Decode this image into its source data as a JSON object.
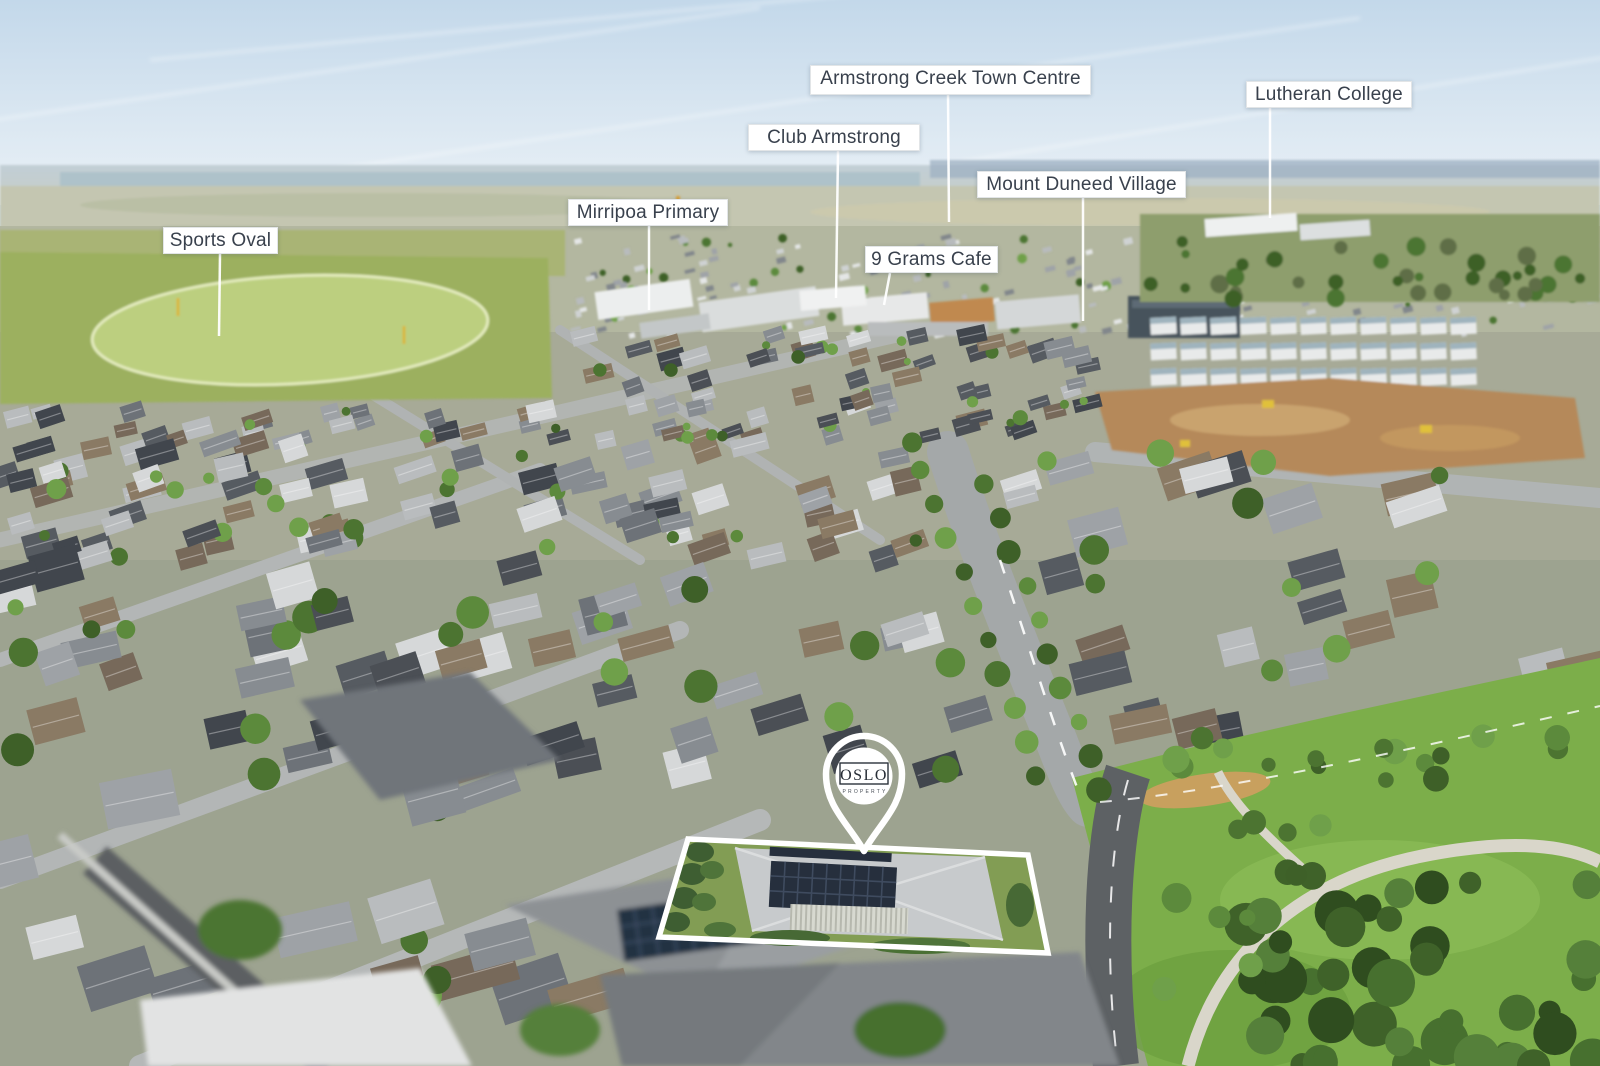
{
  "scene": {
    "type": "aerial drone photograph",
    "description": "Aerial view over a new housing estate with location callouts and a highlighted property"
  },
  "labels": [
    {
      "id": "sports-oval",
      "text": "Sports Oval",
      "box": {
        "x": 163,
        "y": 227,
        "w": 115,
        "h": 27
      },
      "line": {
        "x1": 220,
        "y1": 254,
        "x2": 219,
        "y2": 336
      }
    },
    {
      "id": "mirripoa-primary",
      "text": "Mirripoa Primary",
      "box": {
        "x": 568,
        "y": 199,
        "w": 160,
        "h": 27
      },
      "line": {
        "x1": 649,
        "y1": 226,
        "x2": 649,
        "y2": 310
      }
    },
    {
      "id": "club-armstrong",
      "text": "Club Armstrong",
      "box": {
        "x": 748,
        "y": 124,
        "w": 172,
        "h": 27
      },
      "line": {
        "x1": 838,
        "y1": 151,
        "x2": 836,
        "y2": 298
      }
    },
    {
      "id": "armstrong-creek-town-centre",
      "text": "Armstrong Creek Town Centre",
      "box": {
        "x": 810,
        "y": 65,
        "w": 281,
        "h": 30
      },
      "line": {
        "x1": 948,
        "y1": 95,
        "x2": 949,
        "y2": 222
      }
    },
    {
      "id": "nine-grams-cafe",
      "text": "9 Grams Cafe",
      "box": {
        "x": 865,
        "y": 246,
        "w": 133,
        "h": 27
      },
      "line": {
        "x1": 890,
        "y1": 273,
        "x2": 884,
        "y2": 305
      }
    },
    {
      "id": "mount-duneed-village",
      "text": "Mount Duneed Village",
      "box": {
        "x": 977,
        "y": 171,
        "w": 209,
        "h": 27
      },
      "line": {
        "x1": 1083,
        "y1": 198,
        "x2": 1083,
        "y2": 321
      }
    },
    {
      "id": "lutheran-college",
      "text": "Lutheran College",
      "box": {
        "x": 1246,
        "y": 81,
        "w": 166,
        "h": 27
      },
      "line": {
        "x1": 1270,
        "y1": 108,
        "x2": 1270,
        "y2": 218
      }
    }
  ],
  "pin": {
    "brand": "OSLO",
    "tagline": "PROPERTY"
  },
  "property": {
    "outline": [
      [
        688,
        839
      ],
      [
        1028,
        855
      ],
      [
        1048,
        953
      ],
      [
        659,
        937
      ]
    ],
    "pin_tip": [
      864,
      851
    ]
  },
  "colors": {
    "label_background": "#ffffff",
    "label_text": "#39414d",
    "label_border": "#e2e5e7",
    "leader_line": "#ffffff",
    "boundary": "#ffffff",
    "pin": "#ffffff",
    "logo_text": "#272d36"
  }
}
